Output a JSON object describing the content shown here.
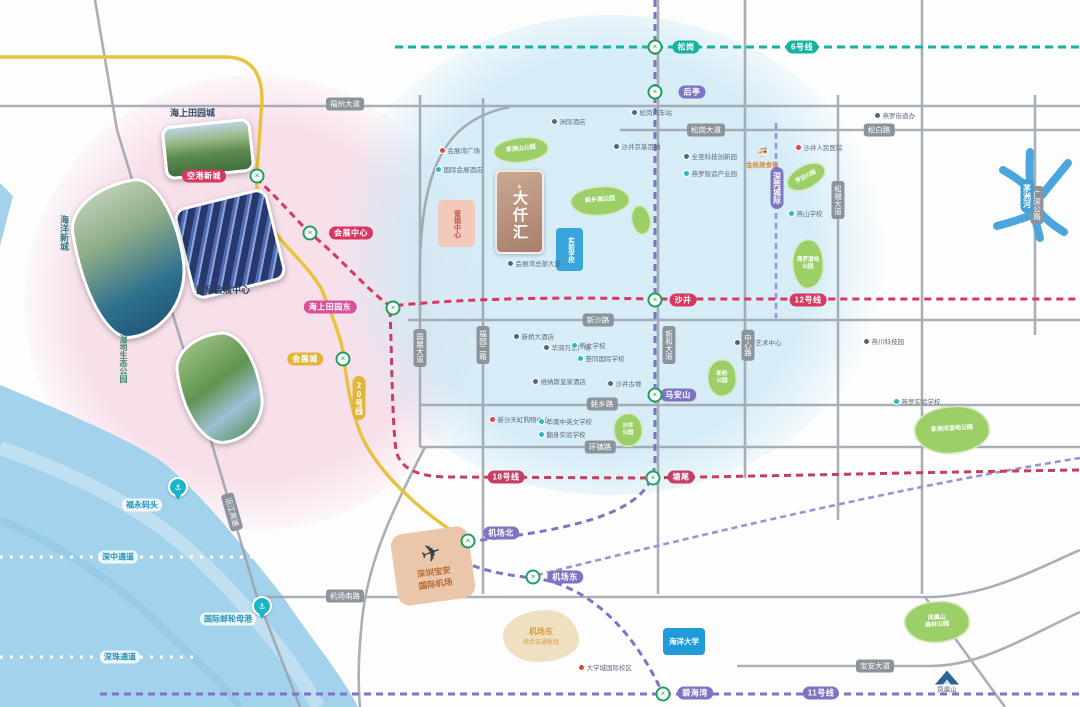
{
  "colors": {
    "line6": "#14b3a0",
    "line11": "#7d74c4",
    "line12": "#d8375f",
    "line18": "#c73e63",
    "line20": "#e7c23d",
    "magenta": "#d8509a",
    "road": "#9aa2ab",
    "park": "#9ccf68",
    "sea": "#a3d2ec",
    "river": "#4aa6dd",
    "station": "#1fa05c"
  },
  "logo": {
    "name": "大仟汇",
    "mark": "▲"
  },
  "blocks": {
    "sales": "营销中心",
    "school": "实验学校",
    "university": "海洋大学",
    "hub_line1": "机场东",
    "hub_line2": "综合交通枢纽",
    "airport_line1": "深圳宝安",
    "airport_line2": "国际机场",
    "mountain": "凤凰山"
  },
  "photos": {
    "waterlands": "海上田园城",
    "expo": "国际会展中心",
    "ocean_city": "海洋新城",
    "wetland": "湿地生态公园"
  },
  "metro_lines": [
    {
      "id": "line6",
      "name": "6号线",
      "color": "#14b3a0"
    },
    {
      "id": "line11",
      "name": "11号线",
      "color": "#7d74c4"
    },
    {
      "id": "line12",
      "name": "12号线",
      "color": "#d8375f"
    },
    {
      "id": "line18",
      "name": "18号线",
      "color": "#c73e63"
    },
    {
      "id": "line20",
      "name": "20号线",
      "color": "#e7c23d"
    },
    {
      "id": "intercity",
      "name": "深莞城际",
      "color": "#7d74c4"
    }
  ],
  "metro_badges": [
    {
      "text": "松岗",
      "x": 686,
      "y": 47,
      "bg": "#14b3a0",
      "v": false
    },
    {
      "text": "6号线",
      "x": 802,
      "y": 47,
      "bg": "#14b3a0",
      "v": false
    },
    {
      "text": "后亭",
      "x": 692,
      "y": 92,
      "bg": "#7d74c4",
      "v": false
    },
    {
      "text": "马安山",
      "x": 678,
      "y": 395,
      "bg": "#7d74c4",
      "v": false
    },
    {
      "text": "机场北",
      "x": 501,
      "y": 533,
      "bg": "#7d74c4",
      "v": false
    },
    {
      "text": "机场东",
      "x": 565,
      "y": 577,
      "bg": "#7d74c4",
      "v": false
    },
    {
      "text": "碧海湾",
      "x": 695,
      "y": 693,
      "bg": "#7d74c4",
      "v": false
    },
    {
      "text": "11号线",
      "x": 821,
      "y": 693,
      "bg": "#7d74c4",
      "v": false
    },
    {
      "text": "深莞城际",
      "x": 777,
      "y": 188,
      "bg": "#7d74c4",
      "v": true
    },
    {
      "text": "空港新城",
      "x": 204,
      "y": 176,
      "bg": "#d8375f",
      "v": false
    },
    {
      "text": "会展中心",
      "x": 351,
      "y": 233,
      "bg": "#d8375f",
      "v": false
    },
    {
      "text": "沙井",
      "x": 683,
      "y": 300,
      "bg": "#d8375f",
      "v": false
    },
    {
      "text": "12号线",
      "x": 808,
      "y": 300,
      "bg": "#d8375f",
      "v": false
    },
    {
      "text": "18号线",
      "x": 506,
      "y": 477,
      "bg": "#c73e63",
      "v": false
    },
    {
      "text": "塘尾",
      "x": 681,
      "y": 477,
      "bg": "#c73e63",
      "v": false
    },
    {
      "text": "海上田园东",
      "x": 330,
      "y": 307,
      "bg": "#d8509a",
      "v": false
    },
    {
      "text": "会展城",
      "x": 305,
      "y": 359,
      "bg": "#e2b43a",
      "v": false
    },
    {
      "text": "20号线",
      "x": 359,
      "y": 398,
      "bg": "#e2b43a",
      "v": true
    },
    {
      "text": "茅洲河",
      "x": 1027,
      "y": 196,
      "bg": "#3f9fd8",
      "v": true
    }
  ],
  "road_badges": [
    {
      "text": "福州大道",
      "x": 345,
      "y": 104,
      "v": false,
      "rot": 0
    },
    {
      "text": "松岗大道",
      "x": 706,
      "y": 130,
      "v": false,
      "rot": 0
    },
    {
      "text": "松白路",
      "x": 879,
      "y": 130,
      "v": false,
      "rot": 0
    },
    {
      "text": "新沙路",
      "x": 598,
      "y": 320,
      "v": false,
      "rot": 0
    },
    {
      "text": "蚝乡路",
      "x": 602,
      "y": 404,
      "v": false,
      "rot": 0
    },
    {
      "text": "环镇路",
      "x": 600,
      "y": 447,
      "v": false,
      "rot": 0
    },
    {
      "text": "宝安大道",
      "x": 875,
      "y": 666,
      "v": false,
      "rot": 0
    },
    {
      "text": "机场南路",
      "x": 345,
      "y": 596,
      "v": false,
      "rot": 0
    },
    {
      "text": "沿江高速",
      "x": 232,
      "y": 512,
      "v": false,
      "rot": 74
    },
    {
      "text": "国展大道",
      "x": 420,
      "y": 348,
      "v": true,
      "rot": 0
    },
    {
      "text": "福园二路",
      "x": 483,
      "y": 345,
      "v": true,
      "rot": 0
    },
    {
      "text": "新和大道",
      "x": 669,
      "y": 345,
      "v": true,
      "rot": 0
    },
    {
      "text": "中心路",
      "x": 748,
      "y": 345,
      "v": true,
      "rot": 0
    },
    {
      "text": "松福大道",
      "x": 838,
      "y": 200,
      "v": true,
      "rot": 0
    },
    {
      "text": "广深公路",
      "x": 1037,
      "y": 205,
      "v": true,
      "rot": 0
    }
  ],
  "water_labels": [
    {
      "text": "福永码头",
      "x": 142,
      "y": 505
    },
    {
      "text": "深中通道",
      "x": 118,
      "y": 557
    },
    {
      "text": "国际邮轮母港",
      "x": 228,
      "y": 619
    },
    {
      "text": "深珠通道",
      "x": 120,
      "y": 657
    }
  ],
  "parks": [
    {
      "label": "茅洲山公园",
      "x": 521,
      "y": 150,
      "rx": 28,
      "ry": 13,
      "rot": -6,
      "fs": 6
    },
    {
      "label": "蚝乡湖公园",
      "x": 600,
      "y": 201,
      "rx": 30,
      "ry": 15,
      "rot": -4,
      "fs": 6
    },
    {
      "label": "罗田公园",
      "x": 806,
      "y": 177,
      "rx": 21,
      "ry": 12,
      "rot": -28,
      "fs": 5.5
    },
    {
      "label": "燕罗湿地\n公园",
      "x": 808,
      "y": 264,
      "rx": 16,
      "ry": 25,
      "rot": 0,
      "fs": 5.5
    },
    {
      "label": "新桥\n公园",
      "x": 722,
      "y": 378,
      "rx": 15,
      "ry": 19,
      "rot": 0,
      "fs": 5.5
    },
    {
      "label": "沙井\n公园",
      "x": 628,
      "y": 430,
      "rx": 15,
      "ry": 17,
      "rot": 0,
      "fs": 5.5
    },
    {
      "label": "",
      "x": 641,
      "y": 220,
      "rx": 10,
      "ry": 15,
      "rot": -10,
      "fs": 5
    },
    {
      "label": "茅洲河湿地公园",
      "x": 952,
      "y": 430,
      "rx": 38,
      "ry": 24,
      "rot": -4,
      "fs": 6
    },
    {
      "label": "凤凰山\n森林公园",
      "x": 937,
      "y": 622,
      "rx": 33,
      "ry": 21,
      "rot": -3,
      "fs": 6
    }
  ],
  "stations": [
    {
      "x": 655,
      "y": 47
    },
    {
      "x": 655,
      "y": 92
    },
    {
      "x": 257,
      "y": 176
    },
    {
      "x": 310,
      "y": 233
    },
    {
      "x": 393,
      "y": 308
    },
    {
      "x": 655,
      "y": 300
    },
    {
      "x": 343,
      "y": 359
    },
    {
      "x": 655,
      "y": 395
    },
    {
      "x": 653,
      "y": 478
    },
    {
      "x": 468,
      "y": 541
    },
    {
      "x": 533,
      "y": 577
    },
    {
      "x": 663,
      "y": 694
    }
  ],
  "pins": [
    {
      "x": 178,
      "y": 497,
      "glyph": "⚓"
    },
    {
      "x": 262,
      "y": 616,
      "glyph": "⚓"
    }
  ],
  "pois": [
    {
      "x": 632,
      "y": 112,
      "c": "#5a6472",
      "label": "松岗汽车站"
    },
    {
      "x": 875,
      "y": 115,
      "c": "#5a6472",
      "label": "燕罗街道办"
    },
    {
      "x": 440,
      "y": 150,
      "c": "#e0483e",
      "label": "会展湾广场"
    },
    {
      "x": 436,
      "y": 169,
      "c": "#29b7c9",
      "label": "国际会展酒店"
    },
    {
      "x": 552,
      "y": 121,
      "c": "#5a6472",
      "label": "洲际酒店"
    },
    {
      "x": 614,
      "y": 146,
      "c": "#5a6472",
      "label": "沙井京基百纳"
    },
    {
      "x": 508,
      "y": 263,
      "c": "#5a6472",
      "label": "会展湾总部大厦"
    },
    {
      "x": 684,
      "y": 156,
      "c": "#5a6472",
      "label": "全至科技创新园"
    },
    {
      "x": 684,
      "y": 173,
      "c": "#29b7c9",
      "label": "燕罗智造产业园"
    },
    {
      "x": 796,
      "y": 147,
      "c": "#e0483e",
      "label": "沙井人民医院"
    },
    {
      "x": 789,
      "y": 213,
      "c": "#29b7c9",
      "label": "燕山学校"
    },
    {
      "x": 864,
      "y": 341,
      "c": "#5a6472",
      "label": "燕川科技园"
    },
    {
      "x": 894,
      "y": 401,
      "c": "#29b7c9",
      "label": "燕罗实验学校"
    },
    {
      "x": 735,
      "y": 342,
      "c": "#5a6472",
      "label": "新桥艺术中心"
    },
    {
      "x": 514,
      "y": 336,
      "c": "#5a6472",
      "label": "新桥大酒店"
    },
    {
      "x": 544,
      "y": 347,
      "c": "#5a6472",
      "label": "华润万家广场"
    },
    {
      "x": 572,
      "y": 345,
      "c": "#29b7c9",
      "label": "崇文学校"
    },
    {
      "x": 578,
      "y": 358,
      "c": "#29b7c9",
      "label": "荟同国际学校"
    },
    {
      "x": 533,
      "y": 381,
      "c": "#5a6472",
      "label": "维纳斯皇家酒店"
    },
    {
      "x": 608,
      "y": 383,
      "c": "#5a6472",
      "label": "沙井古墟"
    },
    {
      "x": 490,
      "y": 419,
      "c": "#e0483e",
      "label": "新沙天虹购物中心"
    },
    {
      "x": 539,
      "y": 421,
      "c": "#29b7c9",
      "label": "华南中英文学校"
    },
    {
      "x": 539,
      "y": 434,
      "c": "#29b7c9",
      "label": "翻身实验学校"
    },
    {
      "x": 579,
      "y": 667,
      "c": "#e0483e",
      "label": "大学城国际校区"
    }
  ],
  "food_poi": {
    "x": 762,
    "y": 158,
    "label": "金蚝美食街"
  }
}
